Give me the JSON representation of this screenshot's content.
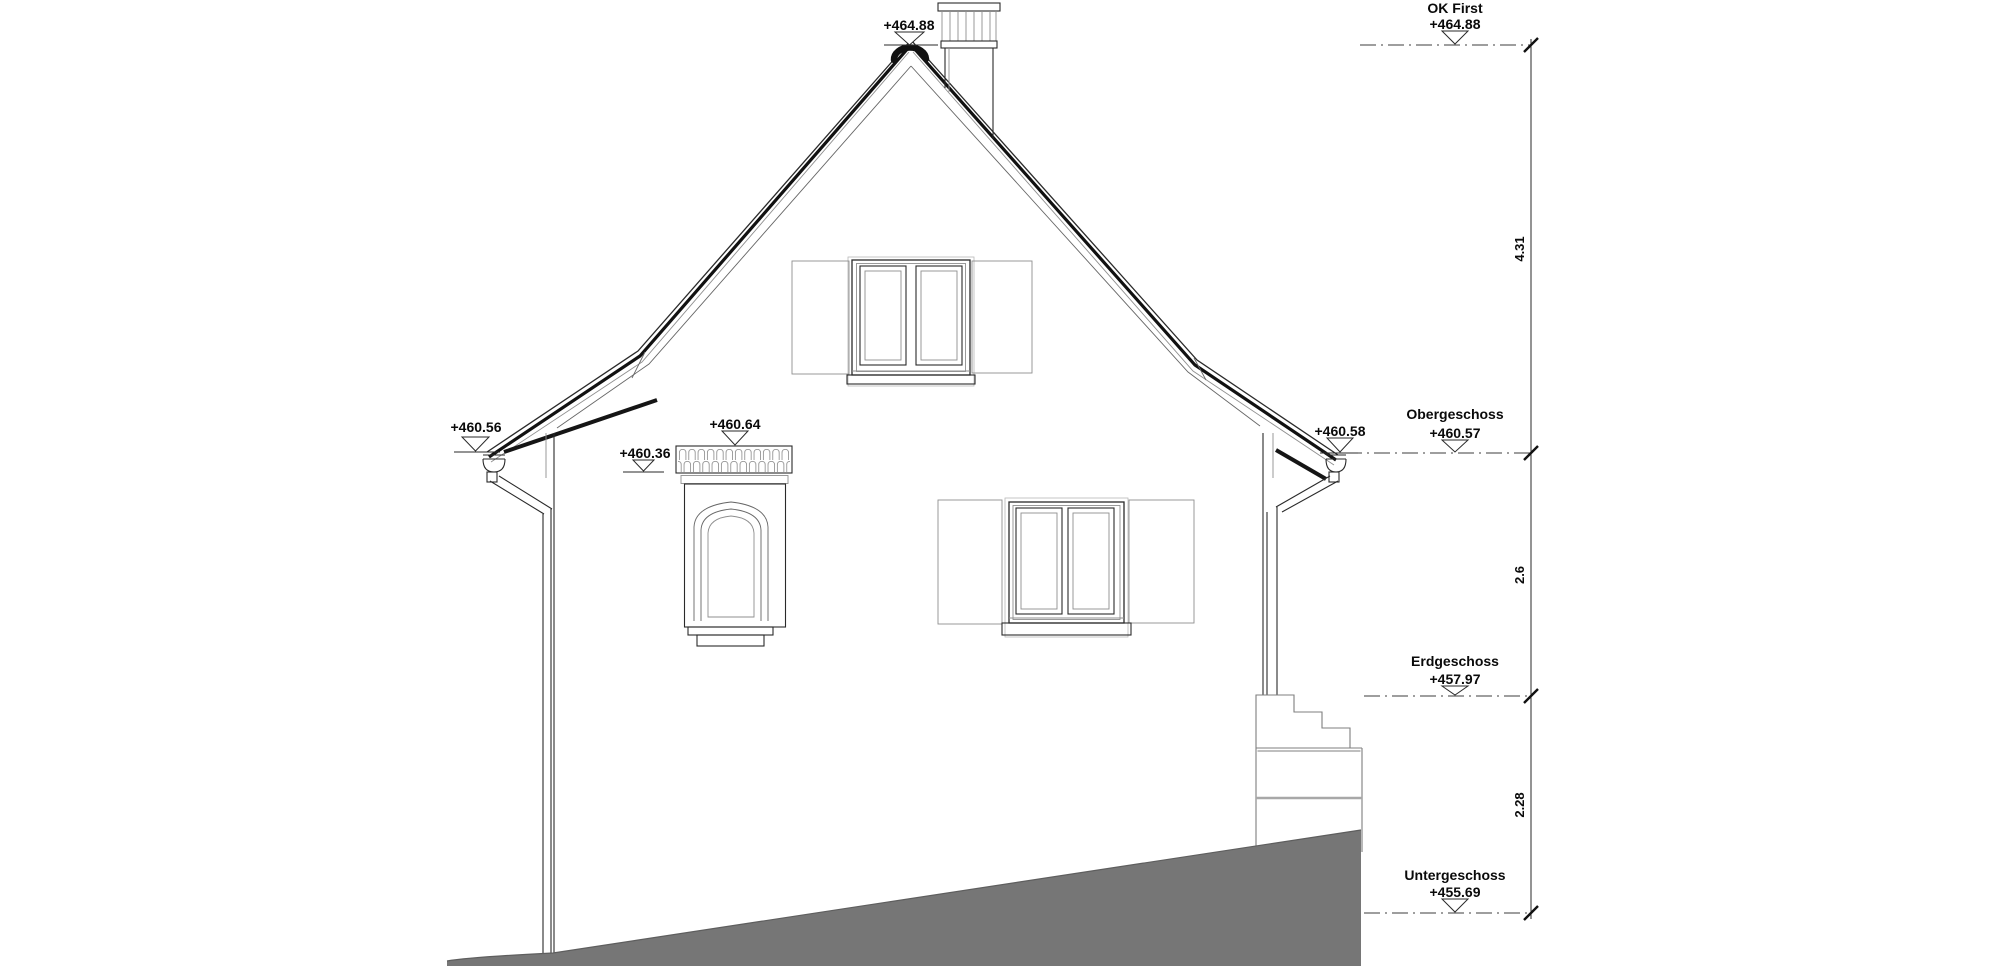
{
  "levels": [
    {
      "name": "OK First",
      "elevation": "+464.88",
      "dim_below": "4.31"
    },
    {
      "name": "Obergeschoss",
      "elevation": "+460.57",
      "dim_below": "2.6"
    },
    {
      "name": "Erdgeschoss",
      "elevation": "+457.97",
      "dim_below": "2.28"
    },
    {
      "name": "Untergeschoss",
      "elevation": "+455.69"
    }
  ],
  "spot_elevations": {
    "ridge": "+464.88",
    "eave_left": "+460.56",
    "bay_cornice_bottom": "+460.36",
    "bay_cornice_top": "+460.64",
    "eave_right": "+460.58"
  },
  "colors": {
    "terrain": "#767676",
    "line": "#222222",
    "background": "#ffffff"
  }
}
